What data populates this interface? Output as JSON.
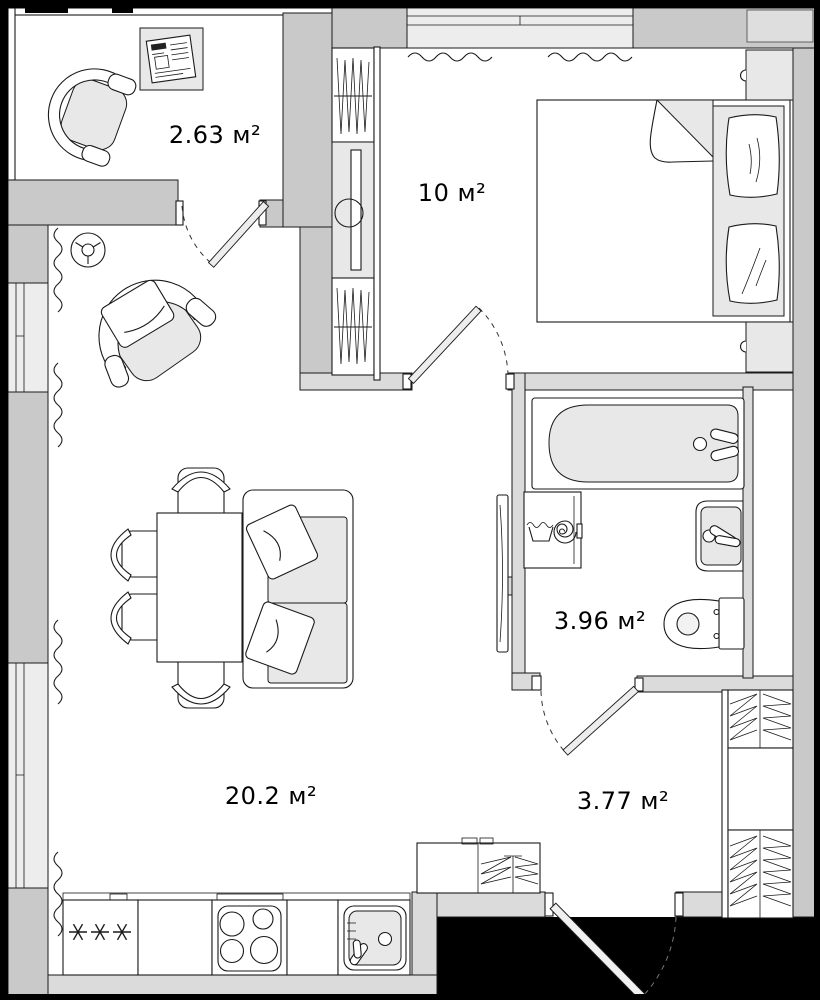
{
  "rooms": [
    {
      "id": "balcony",
      "area_label": "2.63 м²"
    },
    {
      "id": "bedroom",
      "area_label": "10 м²"
    },
    {
      "id": "bathroom",
      "area_label": "3.96 м²"
    },
    {
      "id": "living-kitchen",
      "area_label": "20.2 м²"
    },
    {
      "id": "hallway",
      "area_label": "3.77 м²"
    }
  ],
  "colors": {
    "outside": "#000000",
    "exterior_wall": "#c9c9c9",
    "partition_wall": "#dbdbdb",
    "window_fill": "#ededed",
    "floor": "#ffffff",
    "furniture_fill": "#e8e8e8",
    "outline": "#1a1a1a"
  },
  "icons": [
    "armchair-icon",
    "newspaper-table-icon",
    "ceiling-fan-icon",
    "wardrobe-hanging-icon",
    "mirror-cabinet-icon",
    "bed-icon",
    "pillow-icon",
    "nightstand-icon",
    "bathtub-icon",
    "washing-machine-icon",
    "wash-basin-icon",
    "toilet-icon",
    "sofa-icon",
    "dining-table-icon",
    "chair-icon",
    "fridge-icon",
    "stove-icon",
    "kitchen-sink-icon",
    "storage-shelf-icon",
    "door-leaf",
    "door-swing-arc",
    "window",
    "radiator-icon",
    "mirror-panel-icon"
  ]
}
